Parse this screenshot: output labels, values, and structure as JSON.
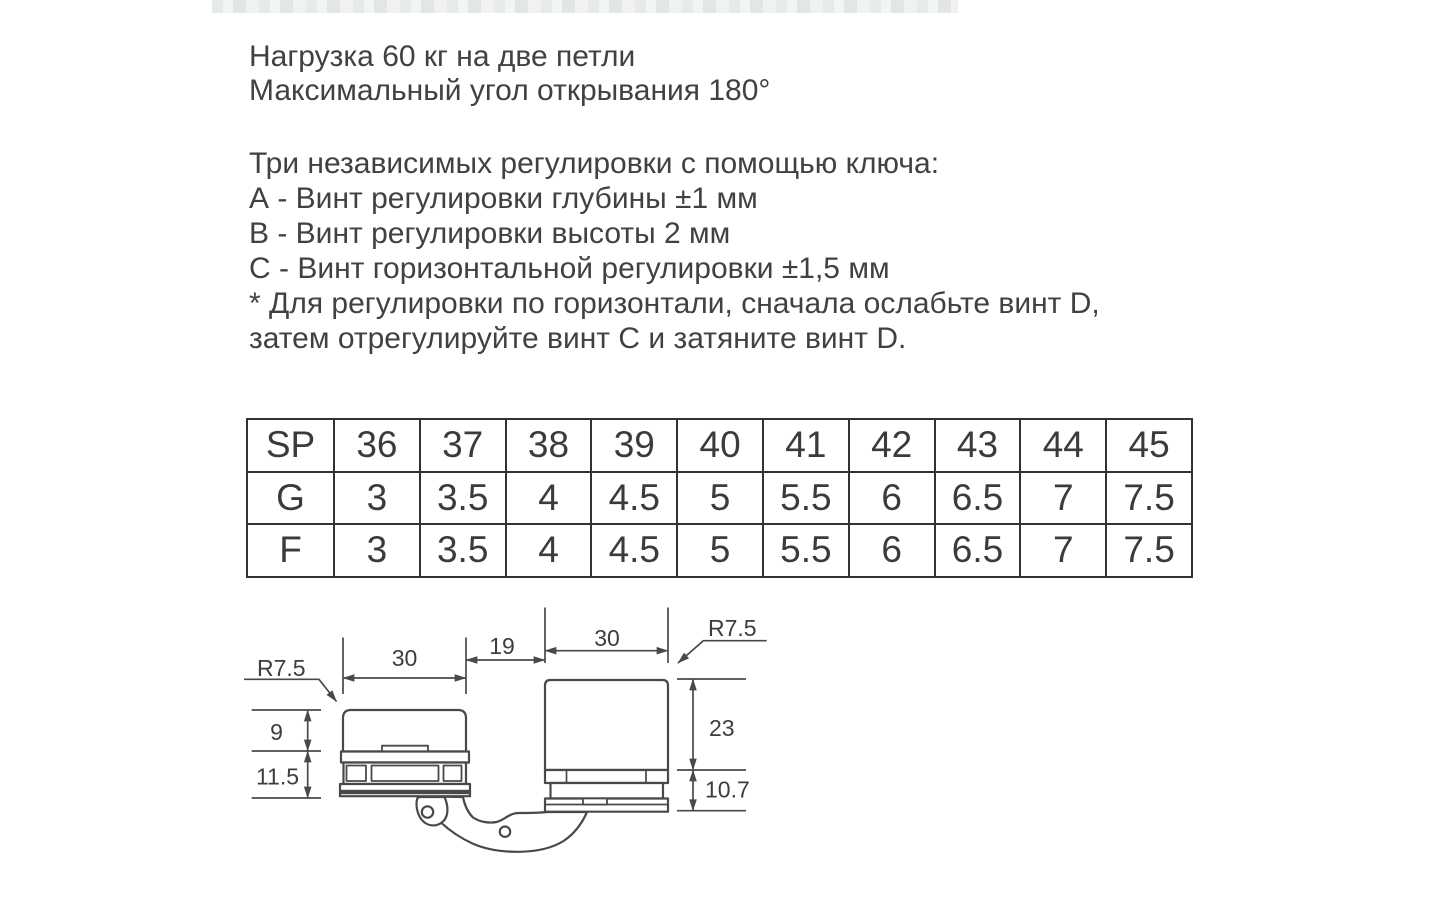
{
  "intro": {
    "line1": "Нагрузка 60 кг на две петли",
    "line2": "Максимальный угол открывания 180°"
  },
  "adjustments": {
    "heading": "Три независимых регулировки с помощью ключа:",
    "items": [
      "А - Винт регулировки глубины ±1 мм",
      "В - Винт регулировки высоты 2 мм",
      "С - Винт горизонтальной регулировки ±1,5 мм"
    ],
    "note_line1": "* Для регулировки по горизонтали, сначала ослабьте винт D,",
    "note_line2": "затем отрегулируйте винт С и затяните винт D."
  },
  "size_table": {
    "rows": [
      {
        "label": "SP",
        "values": [
          "36",
          "37",
          "38",
          "39",
          "40",
          "41",
          "42",
          "43",
          "44",
          "45"
        ]
      },
      {
        "label": "G",
        "values": [
          "3",
          "3.5",
          "4",
          "4.5",
          "5",
          "5.5",
          "6",
          "6.5",
          "7",
          "7.5"
        ]
      },
      {
        "label": "F",
        "values": [
          "3",
          "3.5",
          "4",
          "4.5",
          "5",
          "5.5",
          "6",
          "6.5",
          "7",
          "7.5"
        ]
      }
    ]
  },
  "drawing": {
    "dimensions": {
      "cup_radius": "R7.5",
      "plate_radius": "R7.5",
      "cup_width": "30",
      "gap_width": "19",
      "plate_width": "30",
      "cup_upper_height": "9",
      "cup_lower_height": "11.5",
      "plate_height": "23",
      "plate_lower_height": "10.7"
    }
  },
  "colors": {
    "line": "#494949",
    "text": "#414141",
    "table_border": "#333333"
  }
}
